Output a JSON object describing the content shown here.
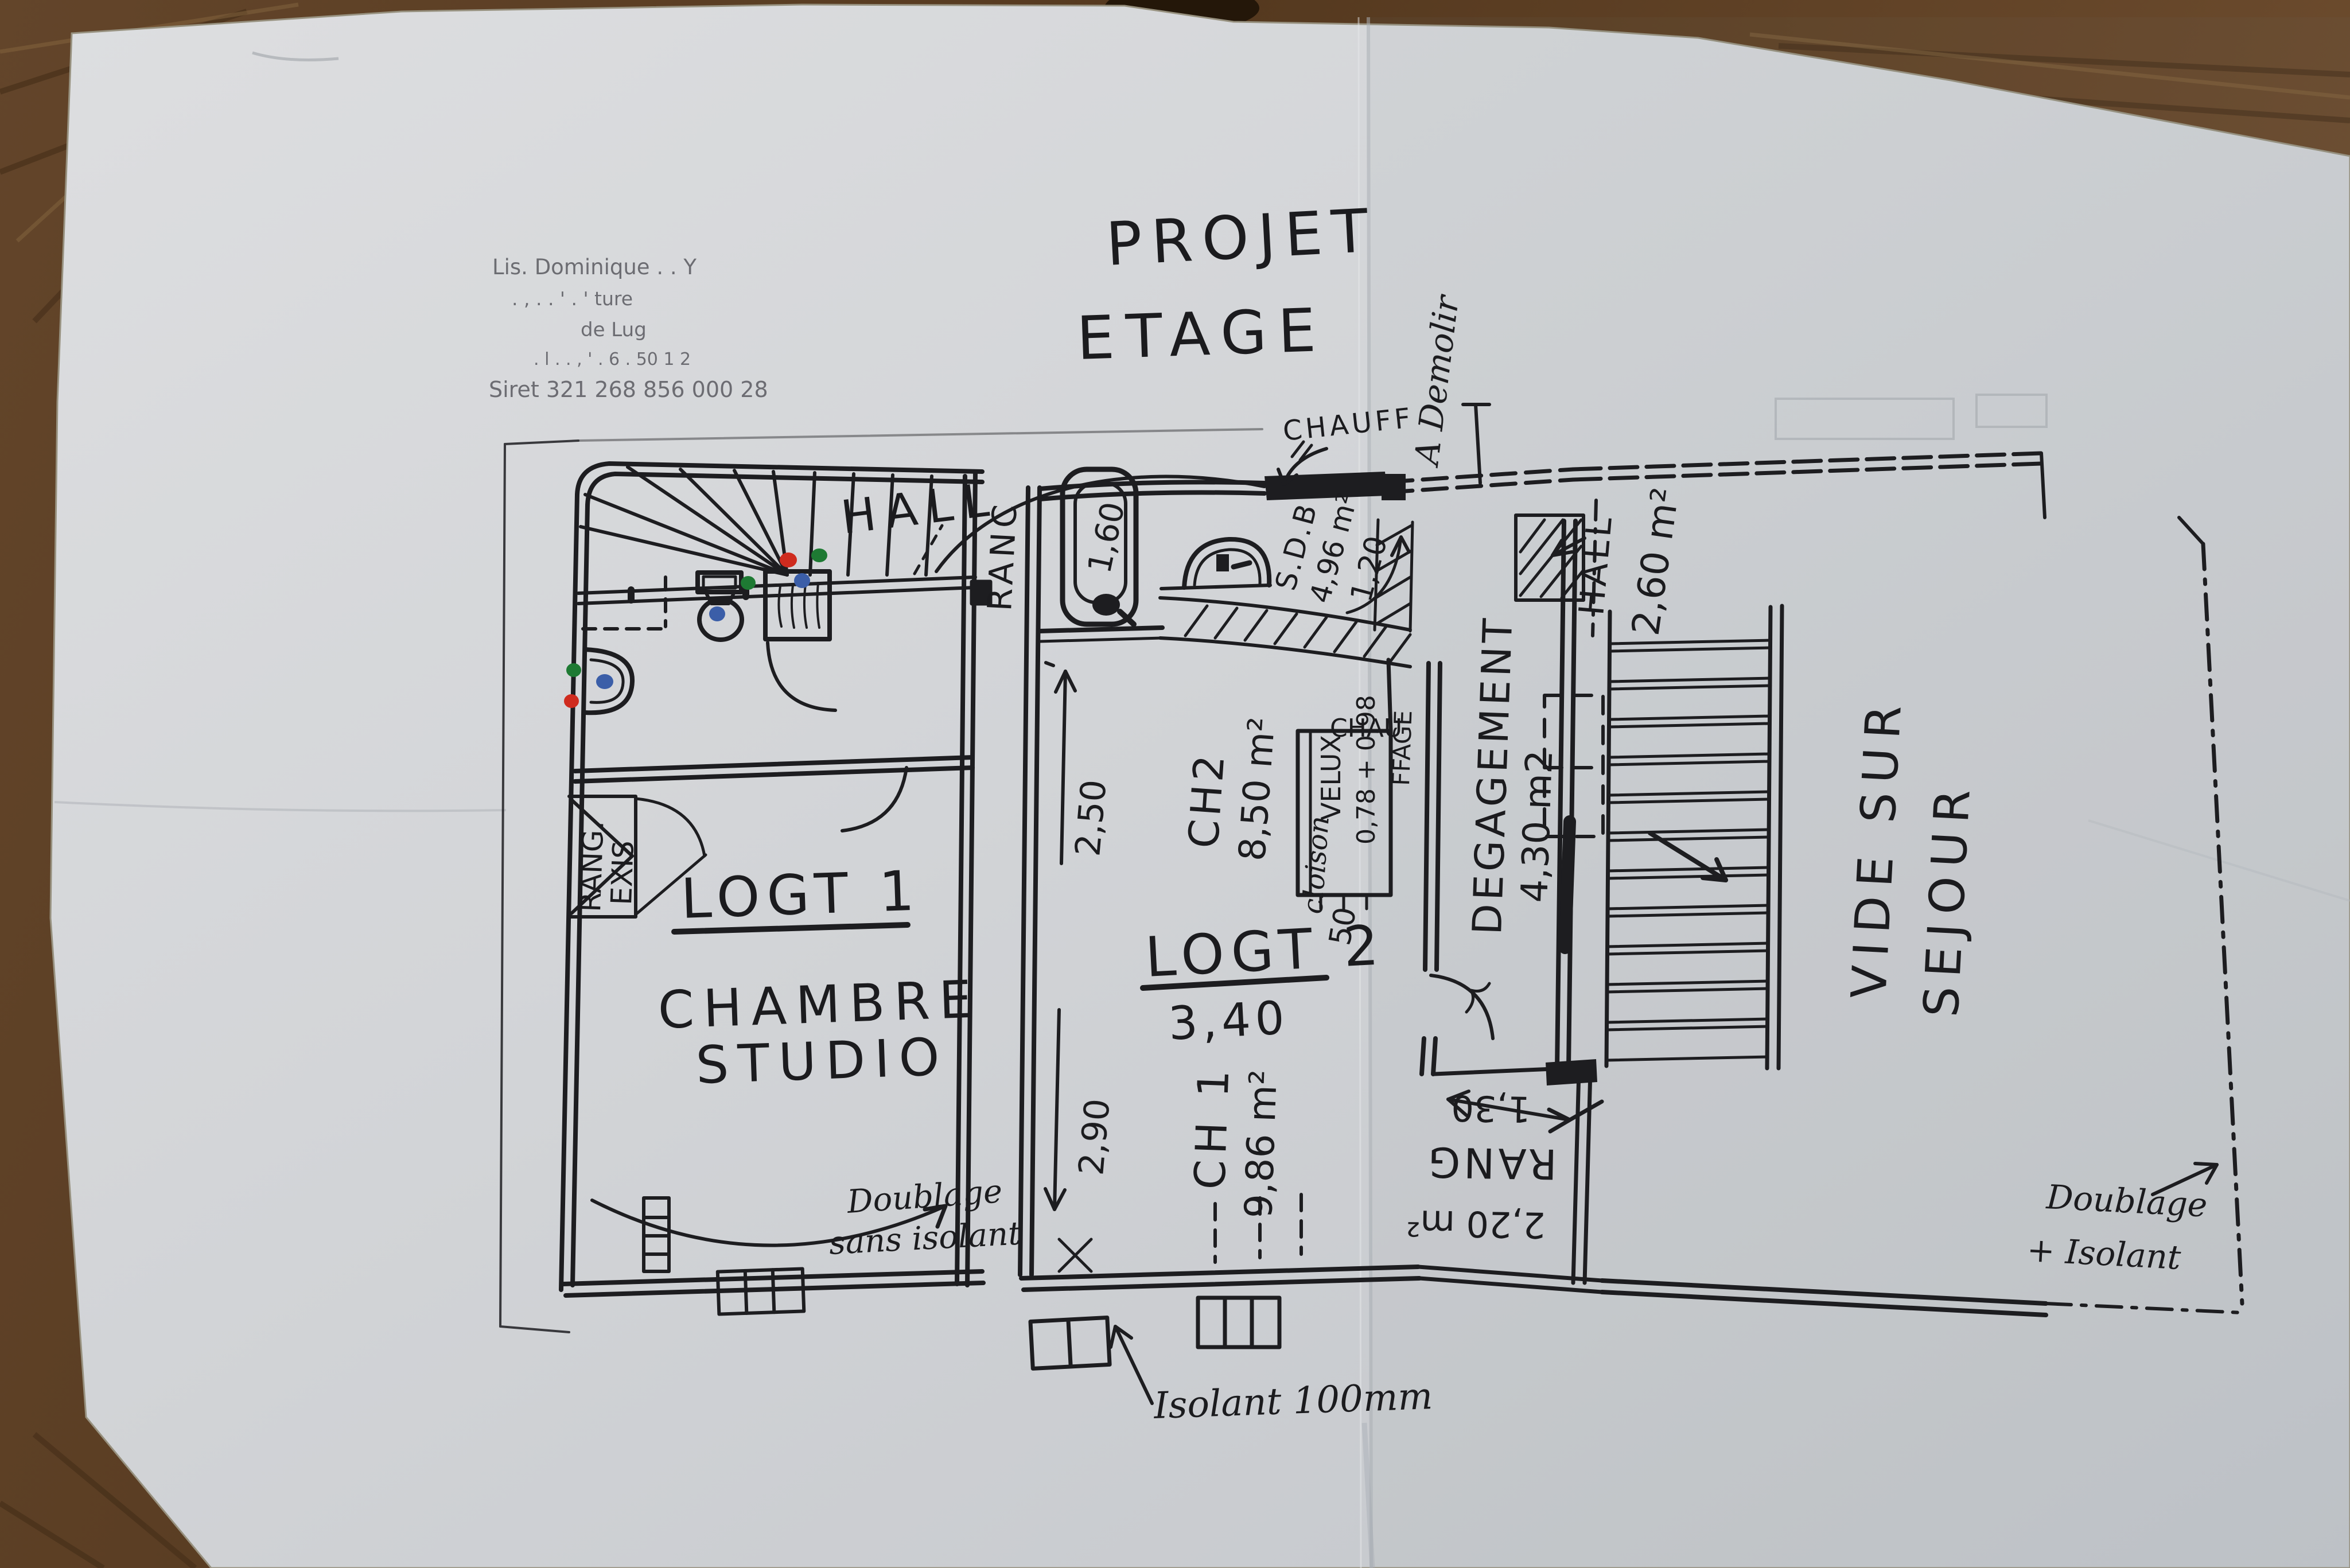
{
  "photo": {
    "description": "hand-drawn first-floor plan on paper on wooden table",
    "paper_color": "#d6d8da",
    "wood_color": "#5e4128",
    "ink_color": "#1d1d20",
    "marker_red": "#cf2b1e",
    "marker_green": "#1e7a33",
    "marker_blue": "#3b5ea8"
  },
  "stamp": {
    "line1": "Lis. Dominique .  .  Y",
    "line2": ".   ,  .  . '  .  '  ture",
    "line3": "de Lug",
    "line4": ". l .   .  , ' .    6 . 50 1 2",
    "siret": "Siret 321 268 856 000 28"
  },
  "title": {
    "line1": "PROJET",
    "line2": "ETAGE"
  },
  "left_unit": {
    "hall": "HALL",
    "ranc": "RANC",
    "name": "LOGT 1",
    "room1": "CHAMBRE",
    "room2": "STUDIO",
    "closet1": "RANG.",
    "closet2": "EXIS",
    "note1": "Doublage",
    "note2": "sans isolant"
  },
  "middle_unit": {
    "name": "LOGT 2",
    "width": "3,40",
    "bath": "S.D.B",
    "bath_area": "4,96 m²",
    "bath_dim": "1,20",
    "tub_dim": "1,60",
    "ch2": "CH2",
    "ch2_area": "8,50 m²",
    "ch2_dim": "2,50",
    "ch1": "CH 1",
    "ch1_area": "9,86 m²",
    "ch1_dim": "2,90",
    "velux": "VELUX",
    "velux_dim": "0,78 + 0,98",
    "chauffage1": "CHAU",
    "chauffage2": "FFAGE",
    "cloison": "cloison",
    "cloison_dim": "50"
  },
  "right_wing": {
    "hall": "HALL",
    "hall_area": "2,60 m²",
    "degagement": "DEGAGEMENT",
    "degagement_area": "4,30 m2",
    "rang": "RANG",
    "rang_area": "2,20 m²",
    "rang_dim": "1,30",
    "vide1": "VIDE SUR",
    "vide2": "SEJOUR"
  },
  "annotations": {
    "chauff": "CHAUFF",
    "a_demolir": "A Demolir",
    "isolant": "Isolant 100mm",
    "doublage1": "Doublage",
    "doublage2": "+ Isolant"
  }
}
